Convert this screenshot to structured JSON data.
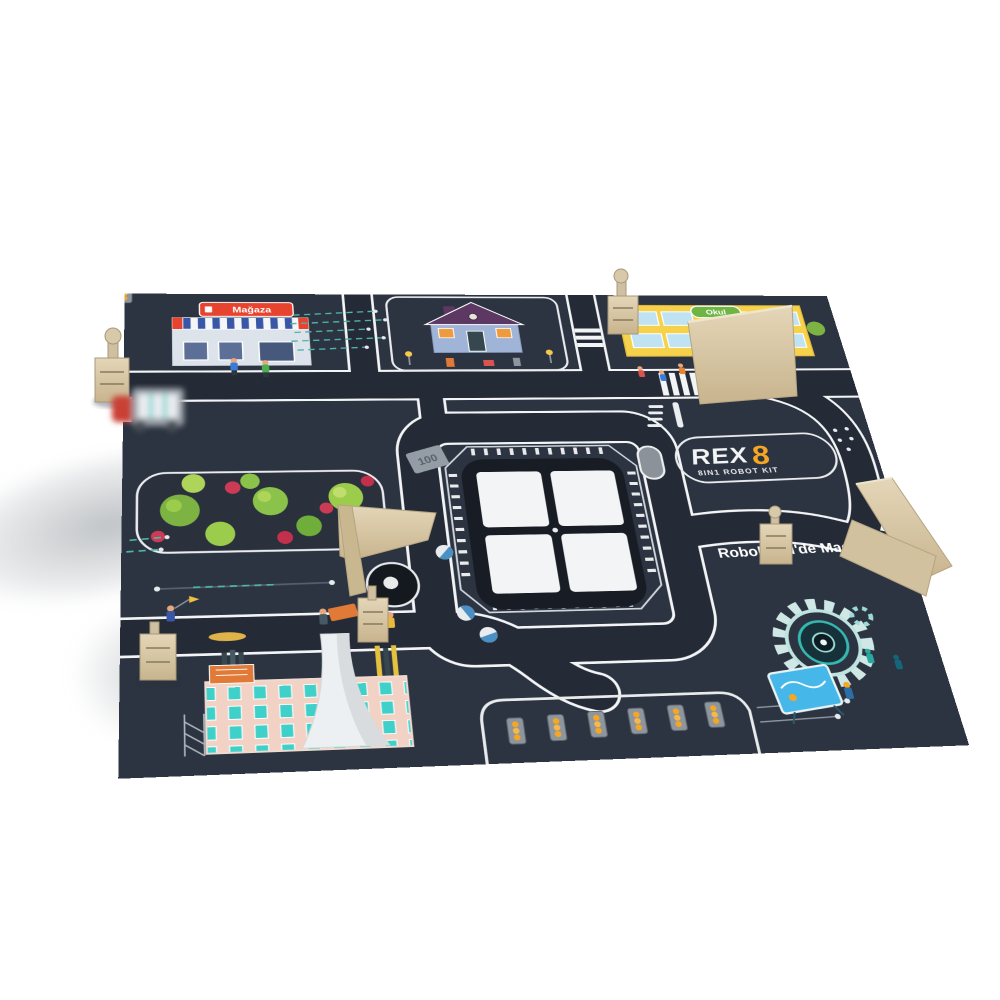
{
  "branding": {
    "logo_text": "REX",
    "logo_digit": "8",
    "logo_subtitle": "8IN1 ROBOT KIT",
    "tagline": "RoboLand'de Maceraya Ka"
  },
  "signs": {
    "store": "Mağaza",
    "school": "Okul",
    "speed_marker": "100"
  },
  "colors": {
    "background": "#ffffff",
    "mat": "#2c3441",
    "road": "#252b36",
    "road_line": "#f2f4f6",
    "wood": "#d8c8a7",
    "accent_orange": "#f5a623",
    "store_sign_red": "#e8432e",
    "school_sign_green": "#6fb544",
    "school_yellow": "#f6d14b",
    "factory_pink": "#f3d2c6",
    "factory_window_teal": "#3fd0c9",
    "tree_green": "#8bc34a",
    "bush_red": "#cc3b55",
    "trace_teal": "#4db6ac",
    "pie_blue": "#4a90c4",
    "traffic_light_orange": "#f5a623"
  }
}
